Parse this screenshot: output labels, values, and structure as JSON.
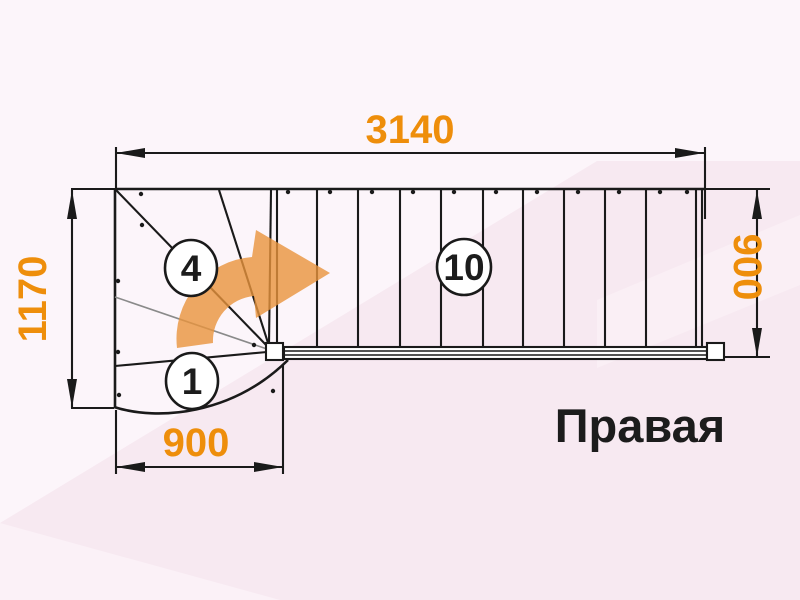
{
  "diagram": {
    "type": "staircase-floor-plan",
    "orientation_label": "Правая",
    "dimensions": {
      "top_width": "3140",
      "left_height": "1170",
      "bottom_width": "900",
      "right_height": "900"
    },
    "step_labels": [
      {
        "id": "step-1",
        "label": "1"
      },
      {
        "id": "step-4",
        "label": "4"
      },
      {
        "id": "step-10",
        "label": "10"
      }
    ],
    "turn_arrow": "curved-right-turn-arrow",
    "colors": {
      "dimension_text": "#EE8E0B",
      "line": "#1A1A1A",
      "winder_minor_line": "#8A8A8A",
      "arrow_fill": "#E8933C",
      "label_text": "#1C1C1C",
      "background_base": "#FCF5FA",
      "background_pink": "#F7E9F1",
      "background_pink_light": "#FBF1F7",
      "background_streak": "#FAEFF5",
      "stair_fill": "#FFFFFF"
    }
  }
}
